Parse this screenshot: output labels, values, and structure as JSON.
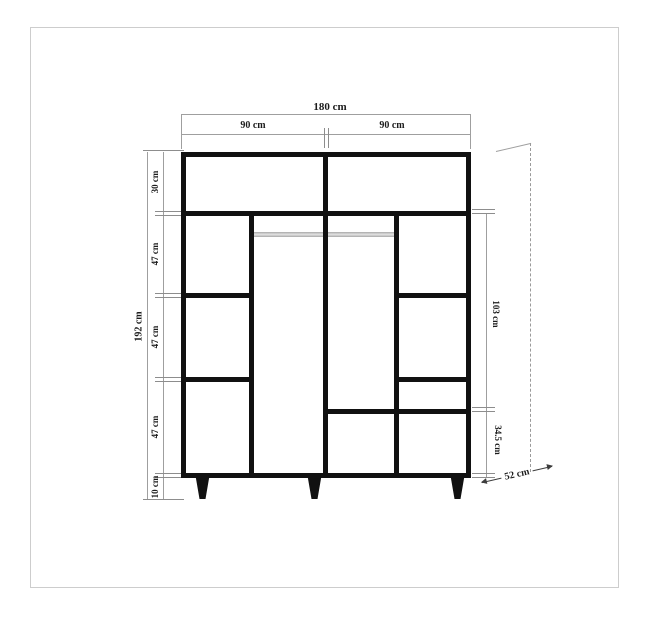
{
  "diagram": {
    "type": "furniture-dimension-drawing",
    "subject": "wardrobe front elevation with dimensions",
    "top": {
      "total_width": "180 cm",
      "left_section": "90 cm",
      "right_section": "90 cm"
    },
    "left": {
      "total_height": "192 cm",
      "segments": [
        {
          "label": "30 cm"
        },
        {
          "label": "47 cm"
        },
        {
          "label": "47 cm"
        },
        {
          "label": "47 cm"
        },
        {
          "label": "10 cm"
        }
      ]
    },
    "right": {
      "upper_section": "103 cm",
      "lower_section": "34.5 cm"
    },
    "depth": {
      "label": "52 cm"
    },
    "colors": {
      "outline": "#111111",
      "dimension_line": "#9f9f9f",
      "rail": "#b5b5b5",
      "text": "#1c1c1c",
      "border": "#cdcdcd"
    }
  }
}
